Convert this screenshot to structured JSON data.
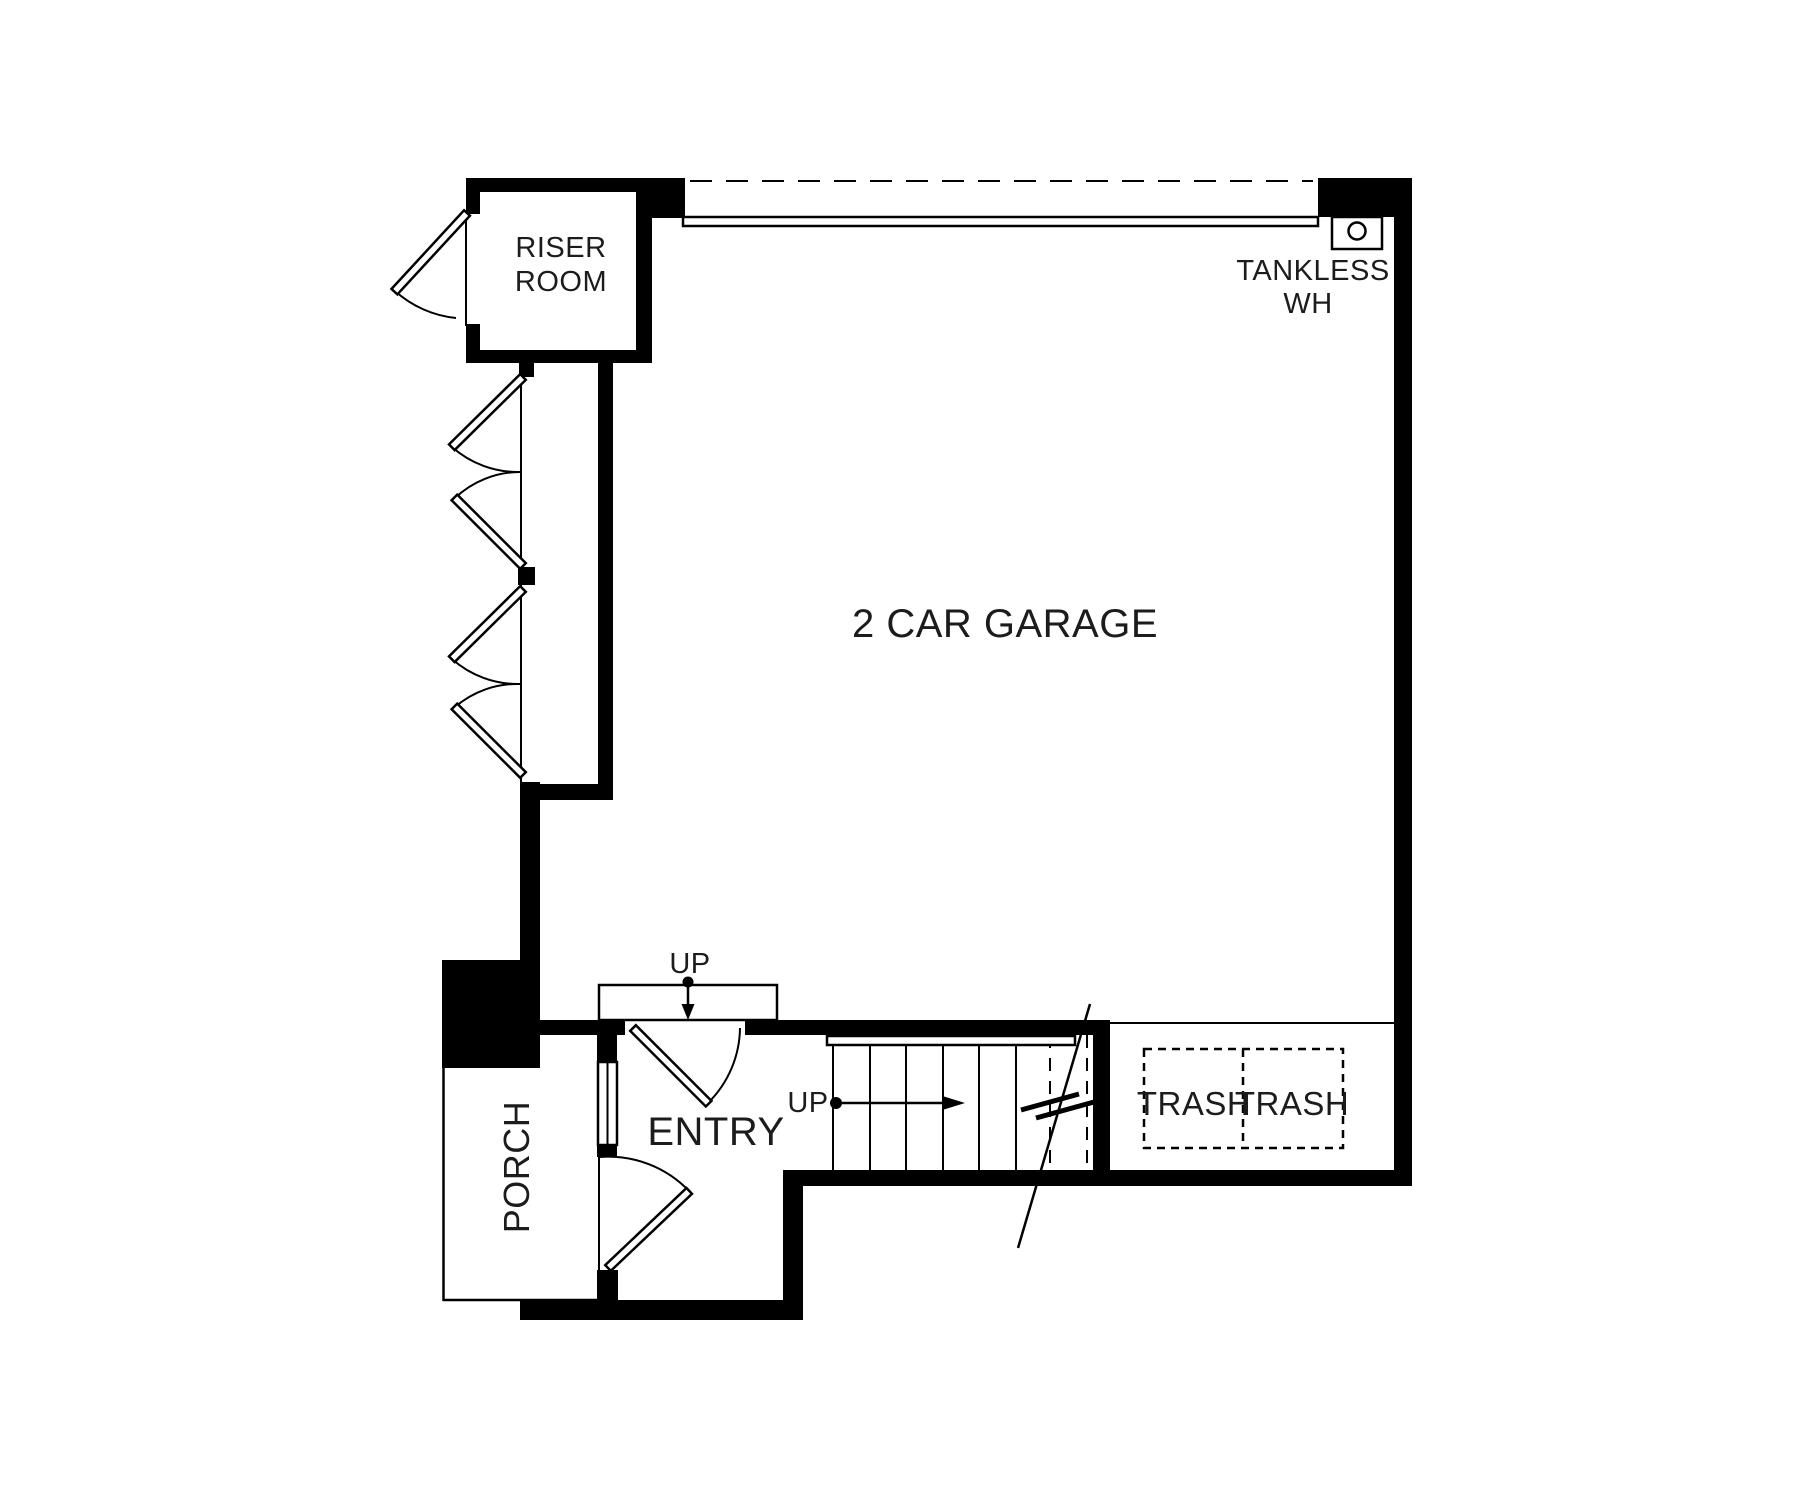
{
  "colors": {
    "ink": "#000000",
    "paper": "#ffffff",
    "text": "#1c1c1c"
  },
  "rooms": {
    "garage": {
      "label": "2 CAR GARAGE"
    },
    "riser": {
      "line1": "RISER",
      "line2": "ROOM"
    },
    "entry": {
      "label": "ENTRY"
    },
    "porch": {
      "label": "PORCH"
    }
  },
  "fixtures": {
    "tankless": {
      "line1": "TANKLESS",
      "line2": "WH"
    },
    "trash": {
      "left": "TRASH",
      "right": "TRASH"
    }
  },
  "stairs": {
    "up_main": "UP",
    "up_entry": "UP"
  }
}
